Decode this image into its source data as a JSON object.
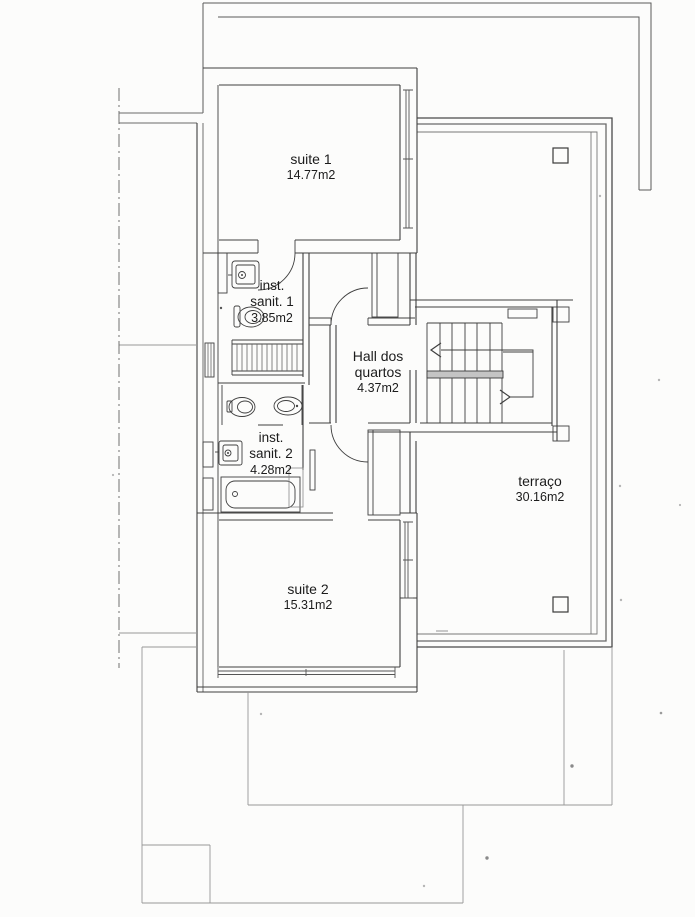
{
  "colors": {
    "ink": "#3f3f3f",
    "faint": "#979797",
    "paper": "#fcfcfb"
  },
  "rooms": {
    "suite1": {
      "name": "suite 1",
      "area": "14.77m2"
    },
    "sanit1": {
      "line1": "inst.",
      "line2": "sanit. 1",
      "area": "3.85m2"
    },
    "hall": {
      "line1": "Hall dos",
      "line2": "quartos",
      "area": "4.37m2"
    },
    "sanit2": {
      "line1": "inst.",
      "line2": "sanit. 2",
      "area": "4.28m2"
    },
    "terraco": {
      "name": "terraço",
      "area": "30.16m2"
    },
    "suite2": {
      "name": "suite 2",
      "area": "15.31m2"
    }
  }
}
